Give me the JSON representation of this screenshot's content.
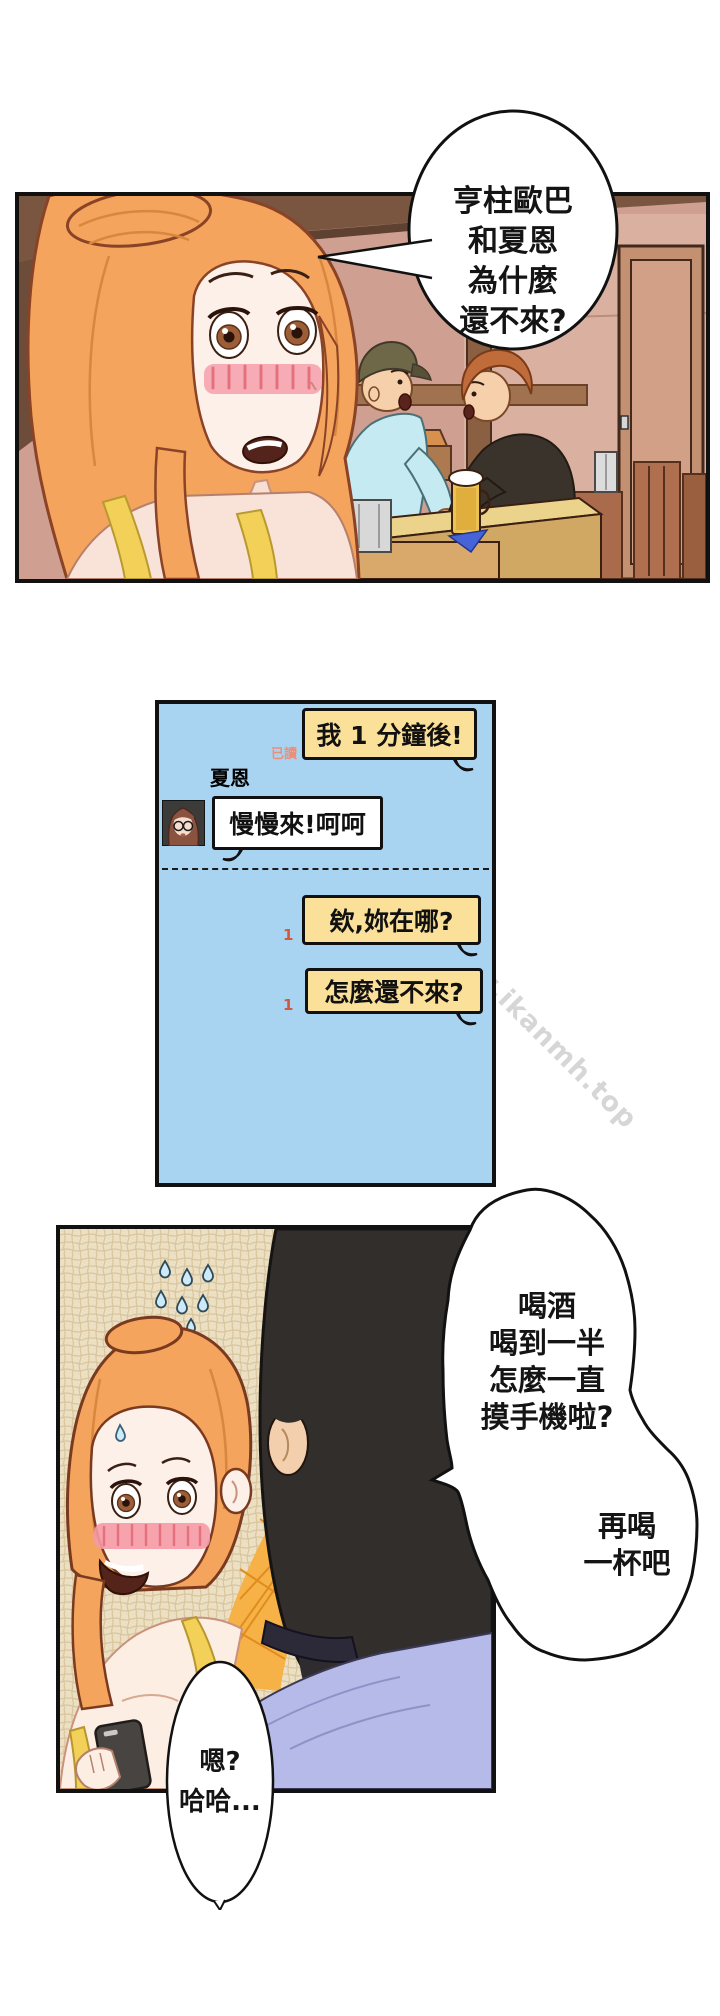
{
  "colors": {
    "page_bg": "#ffffff",
    "panel_border": "#111111",
    "chat_bg": "#a9d4f1",
    "chat_bubble_yellow": "#fae098",
    "chat_bubble_white": "#ffffff",
    "read_label": "#ea8f7a",
    "unread_badge": "#cf5a3d",
    "watermark": "#bcbcbc",
    "girl_hair": "#f4a45c",
    "man_hair": "#312e2c",
    "man_shirt": "#b6bae8"
  },
  "panel1": {
    "speech_bubble": {
      "lines": [
        "亨柱歐巴",
        "和夏恩",
        "為什麼",
        "還不來?"
      ]
    }
  },
  "chat": {
    "contact_name": "夏恩",
    "read_label": "已讀",
    "messages": [
      {
        "sender": "me",
        "text": "我 1 分鐘後!",
        "status": "已讀"
      },
      {
        "sender": "夏恩",
        "text": "慢慢來!呵呵"
      },
      {
        "sender": "me",
        "text": "欸,妳在哪?",
        "unread_count": "1"
      },
      {
        "sender": "me",
        "text": "怎麼還不來?",
        "unread_count": "1"
      }
    ]
  },
  "watermark": {
    "text": "www.ikanmh.top"
  },
  "panel3": {
    "bubble_drink": {
      "lines": [
        "喝酒",
        "喝到一半",
        "怎麼一直",
        "摸手機啦?"
      ]
    },
    "bubble_toast": {
      "lines": [
        "再喝",
        "一杯吧"
      ]
    }
  },
  "bubble_reply": {
    "lines": [
      "嗯?",
      "哈哈..."
    ]
  }
}
